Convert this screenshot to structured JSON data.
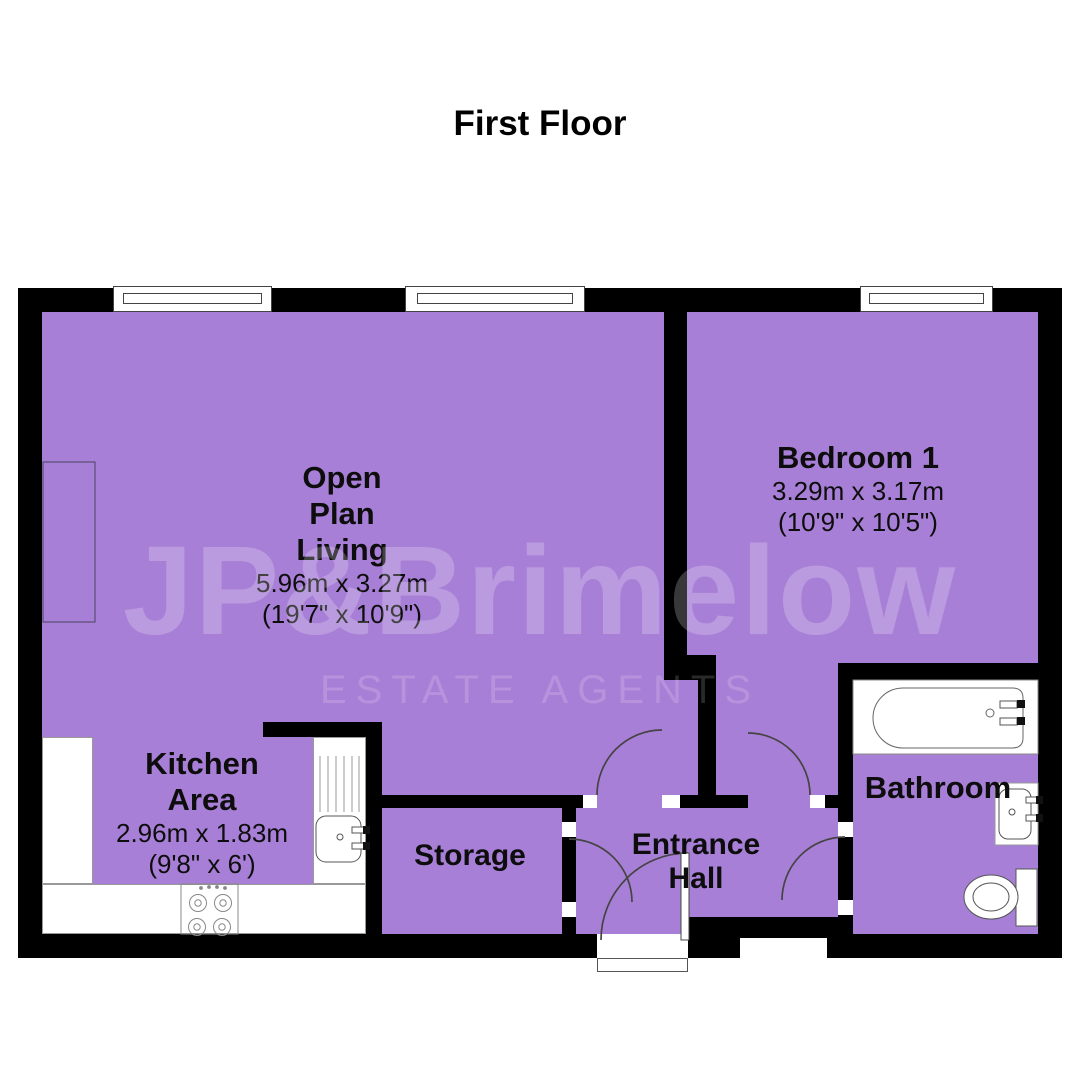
{
  "title": "First Floor",
  "watermark": {
    "brand": "JP&Brimelow",
    "tagline": "ESTATE AGENTS"
  },
  "colors": {
    "floor_fill": "#a87fd6",
    "wall": "#000000",
    "label_text": "#0d0d0d",
    "watermark_tint": "#ffffff"
  },
  "rooms": {
    "open_plan_living": {
      "name_lines": [
        "Open",
        "Plan",
        "Living"
      ],
      "metric": "5.96m x 3.27m",
      "imperial": "(19'7\" x 10'9\")"
    },
    "bedroom_1": {
      "name_lines": [
        "Bedroom 1"
      ],
      "metric": "3.29m x 3.17m",
      "imperial": "(10'9\" x 10'5\")"
    },
    "kitchen_area": {
      "name_lines": [
        "Kitchen",
        "Area"
      ],
      "metric": "2.96m x 1.83m",
      "imperial": "(9'8\" x 6')"
    },
    "storage": {
      "name_lines": [
        "Storage"
      ]
    },
    "entrance_hall": {
      "name_lines": [
        "Entrance",
        "Hall"
      ]
    },
    "bathroom": {
      "name_lines": [
        "Bathroom"
      ]
    }
  },
  "fixtures": {
    "bathtub": "bathtub with taps",
    "bathroom_sink": "wash basin with taps",
    "toilet": "toilet with cistern",
    "kitchen_sink": "kitchen sink with drainer and taps",
    "hob": "four-ring hob",
    "window_count": 3,
    "door_count": 5
  }
}
